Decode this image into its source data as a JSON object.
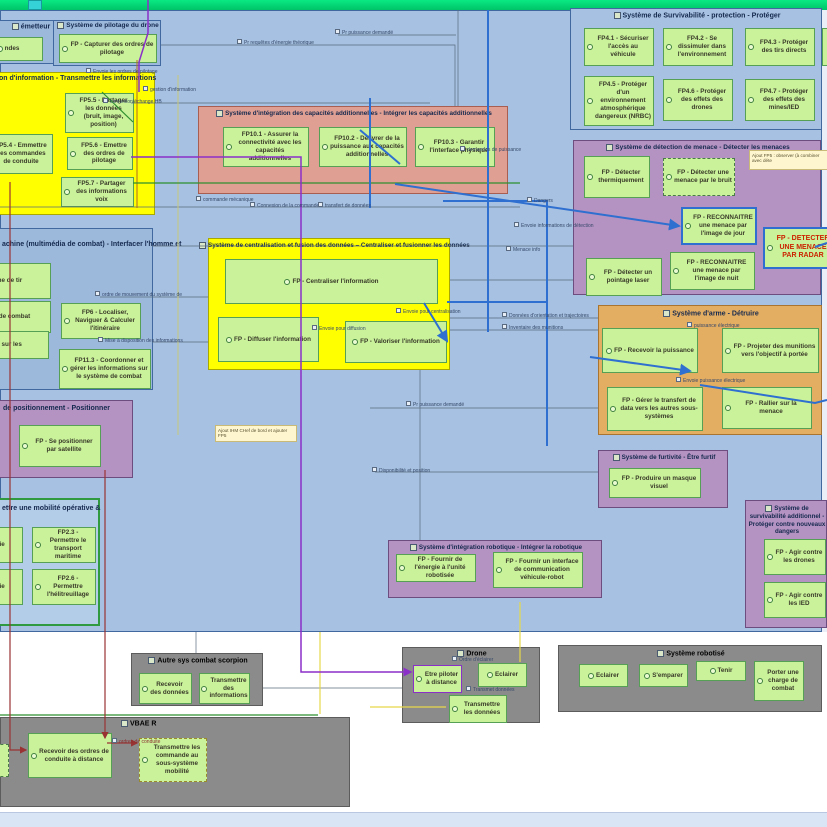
{
  "colors": {
    "canvas_blue": "#a6c1e1",
    "top_bar_green": "#09e982",
    "function_green": "#c9f29b",
    "yellow_block": "#ffff00",
    "salmon_block": "#df9f93",
    "purple_block": "#b493c2",
    "orange_block": "#e3ad62",
    "gray_block": "#8b8b8b",
    "radar_text_red": "#cc2200",
    "wire_blue": "#2e6fd0",
    "wire_purple": "#8b2fc9",
    "wire_darkred": "#993333",
    "wire_green": "#2f8f2f",
    "wire_yellow": "#e6d84a"
  },
  "blocks": {
    "emetteur": {
      "title": "émetteur",
      "fns": [
        "ndes"
      ]
    },
    "pilotage_drone": {
      "title": "Système de pilotage du drone",
      "fns": [
        "FP - Capturer des ordres de pilotage"
      ]
    },
    "transmission_info": {
      "title": "on d'information - Transmettre les informations",
      "fns": [
        "FP5.5 - Partager les données (bruit, image, position)",
        "FP5.4 - Emmettre des commandes de conduite",
        "FP5.6 - Emettre des ordres de pilotage",
        "FP5.7 - Partager des informations voix"
      ]
    },
    "survivabilite_protection": {
      "title": "Système de Survivabilité - protection - Protéger",
      "fns": [
        "FP4.1 - Sécuriser l'accès au véhicule",
        "FP4.2 - Se dissimuler dans l'environnement",
        "FP4.3 - Protéger des tirs directs",
        "FP4.5 - Protéger d'un environnement atmosphérique dangereux (NRBC)",
        "FP4.6 - Protéger des effets des drones",
        "FP4.7 - Protéger des effets des mines/IED"
      ]
    },
    "integration_capacites": {
      "title": "Système d'intégration des capacités additionnelles - Intégrer les capacités additionnelles",
      "fns": [
        "FP10.1 - Assurer la connectivité avec les capacités additionnelles",
        "FP10.2 - Délivrer de la puissance aux capacités additionnelles",
        "FP10.3 - Garantir l'interface physique"
      ]
    },
    "detection_menace": {
      "title": "Système de détection de menace - Détecter les menaces",
      "fns": [
        "FP - Détecter thermiquement",
        "FP - Détecter une menace par le bruit",
        "FP - RECONNAITRE une menace par l'image de jour",
        "FP - DETECTER UNE MENACE PAR RADAR",
        "FP - Détecter un pointage laser",
        "FP - RECONNAITRE une menace par l'image de nuit"
      ]
    },
    "centralisation": {
      "title": "Système de centralisation et fusion des données – Centraliser et fusionner les données",
      "fns": [
        "FP - Centraliser l'information",
        "FP - Diffuser l'information",
        "FP - Valoriser l'information"
      ]
    },
    "ihm": {
      "title": "achine (multimédia de combat) - Interfacer l'homme et",
      "fns": [
        "système de tir",
        "système de combat",
        "FP6 - Localiser, Naviguer & Calculer l'itinéraire",
        "rmations sur les",
        "FP11.3 - Coordonner et gérer les informations sur le système de combat"
      ]
    },
    "positionnement": {
      "title": "de positionnement - Positionner",
      "fns": [
        "FP - Se positionner par satellite"
      ]
    },
    "arme": {
      "title": "Système d'arme - Détruire",
      "fns": [
        "FP - Recevoir la puissance",
        "FP - Projeter des munitions vers l'objectif à portée",
        "FP - Gérer le transfert de data vers les autres sous-systèmes",
        "FP - Rallier sur la menace"
      ]
    },
    "furtivite": {
      "title": "Système de furtivité - Être furtif",
      "fns": [
        "FP - Produire un masque visuel"
      ]
    },
    "mobilite": {
      "title": "ettre une mobilité opérative &",
      "fns": [
        "tre le voie",
        "FP2.3 - Permettre le transport maritime",
        "tre le voie",
        "FP2.6 - Permettre l'hélitreuillage"
      ]
    },
    "integration_robotique": {
      "title": "Système d'intégration robotique - Intégrer la robotique",
      "fns": [
        "FP - Fournir de l'énergie à l'unité robotisée",
        "FP - Fournir un interface de communication véhicule-robot"
      ]
    },
    "survivabilite_additionnel": {
      "title": "Système de survivabilité additionnel - Protéger contre nouveaux dangers",
      "fns": [
        "FP - Agir contre les drones",
        "FP - Agir contre les IED"
      ]
    },
    "autre_sys": {
      "title": "Autre sys combat scorpion",
      "fns": [
        "Recevoir des données",
        "Transmettre des informations"
      ]
    },
    "drone": {
      "title": "Drone",
      "fns": [
        "Etre piloter à distance",
        "Eclairer",
        "Transmettre les données"
      ]
    },
    "sys_robotise": {
      "title": "Système robotisé",
      "fns": [
        "Eclairer",
        "S'emparer",
        "Tenir",
        "Porter une charge de combat"
      ]
    },
    "vbae": {
      "title": "VBAE R",
      "fns": [
        "Recevoir des ordres de conduite à distance",
        "Transmettre les commande au sous-système mobilité"
      ]
    }
  },
  "notes": [
    "Ajout FP5 : observer (à combiner avec déte",
    "Ajout IHM CHef de bord et ajouter FP5"
  ],
  "edge_labels": [
    "Pr requêtes d'énergie théorique",
    "Pr puissance demandé",
    "Envoie les ordres de pilotage",
    "gestion d'information",
    "connexion/échange HB",
    "demandes de puissance",
    "commande mécanique",
    "Connexion de la commande",
    "transfert de données",
    "Envoie informations de détection",
    "Menace info",
    "Dangers",
    "Envoie pour centralisation",
    "Envoie pour diffusion",
    "Données d'orientation et trajectoires",
    "Inventaire des munitions",
    "puissance électrique",
    "Envoie puissance électrique",
    "ordre de mouvement du système de",
    "Mise à disposition des informations",
    "Pr puissance demandé",
    "Disponibilité et position",
    "Ordre d'éclairer",
    "Transmet données",
    "ordres de conduite"
  ]
}
